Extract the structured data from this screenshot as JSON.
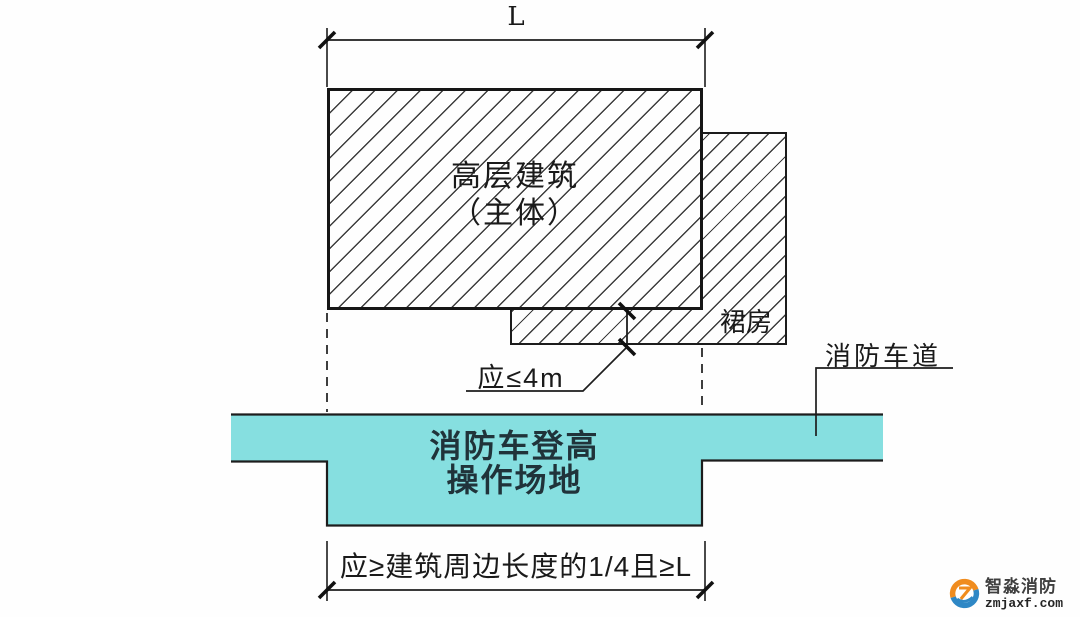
{
  "diagram": {
    "top_dimension": {
      "label": "L"
    },
    "main_building": {
      "line1": "高层建筑",
      "line2": "（主体）"
    },
    "podium": {
      "label": "裙房"
    },
    "gap_dimension": {
      "label": "应≤4m"
    },
    "fire_lane": {
      "label": "消防车道"
    },
    "operation_site": {
      "line1": "消防车登高",
      "line2": "操作场地"
    },
    "bottom_dimension": {
      "label": "应≥建筑周边长度的1/4且≥L"
    }
  },
  "watermark": {
    "brand": "智淼消防",
    "domain": "zmjaxf.com"
  },
  "colors": {
    "lane_fill": "#86dfe0",
    "line": "#1d1d1d",
    "hatch_line": "#3c3c3c",
    "text": "#1a1a1a",
    "logo_orange": "#f08c1e",
    "logo_blue": "#2e87c5"
  }
}
